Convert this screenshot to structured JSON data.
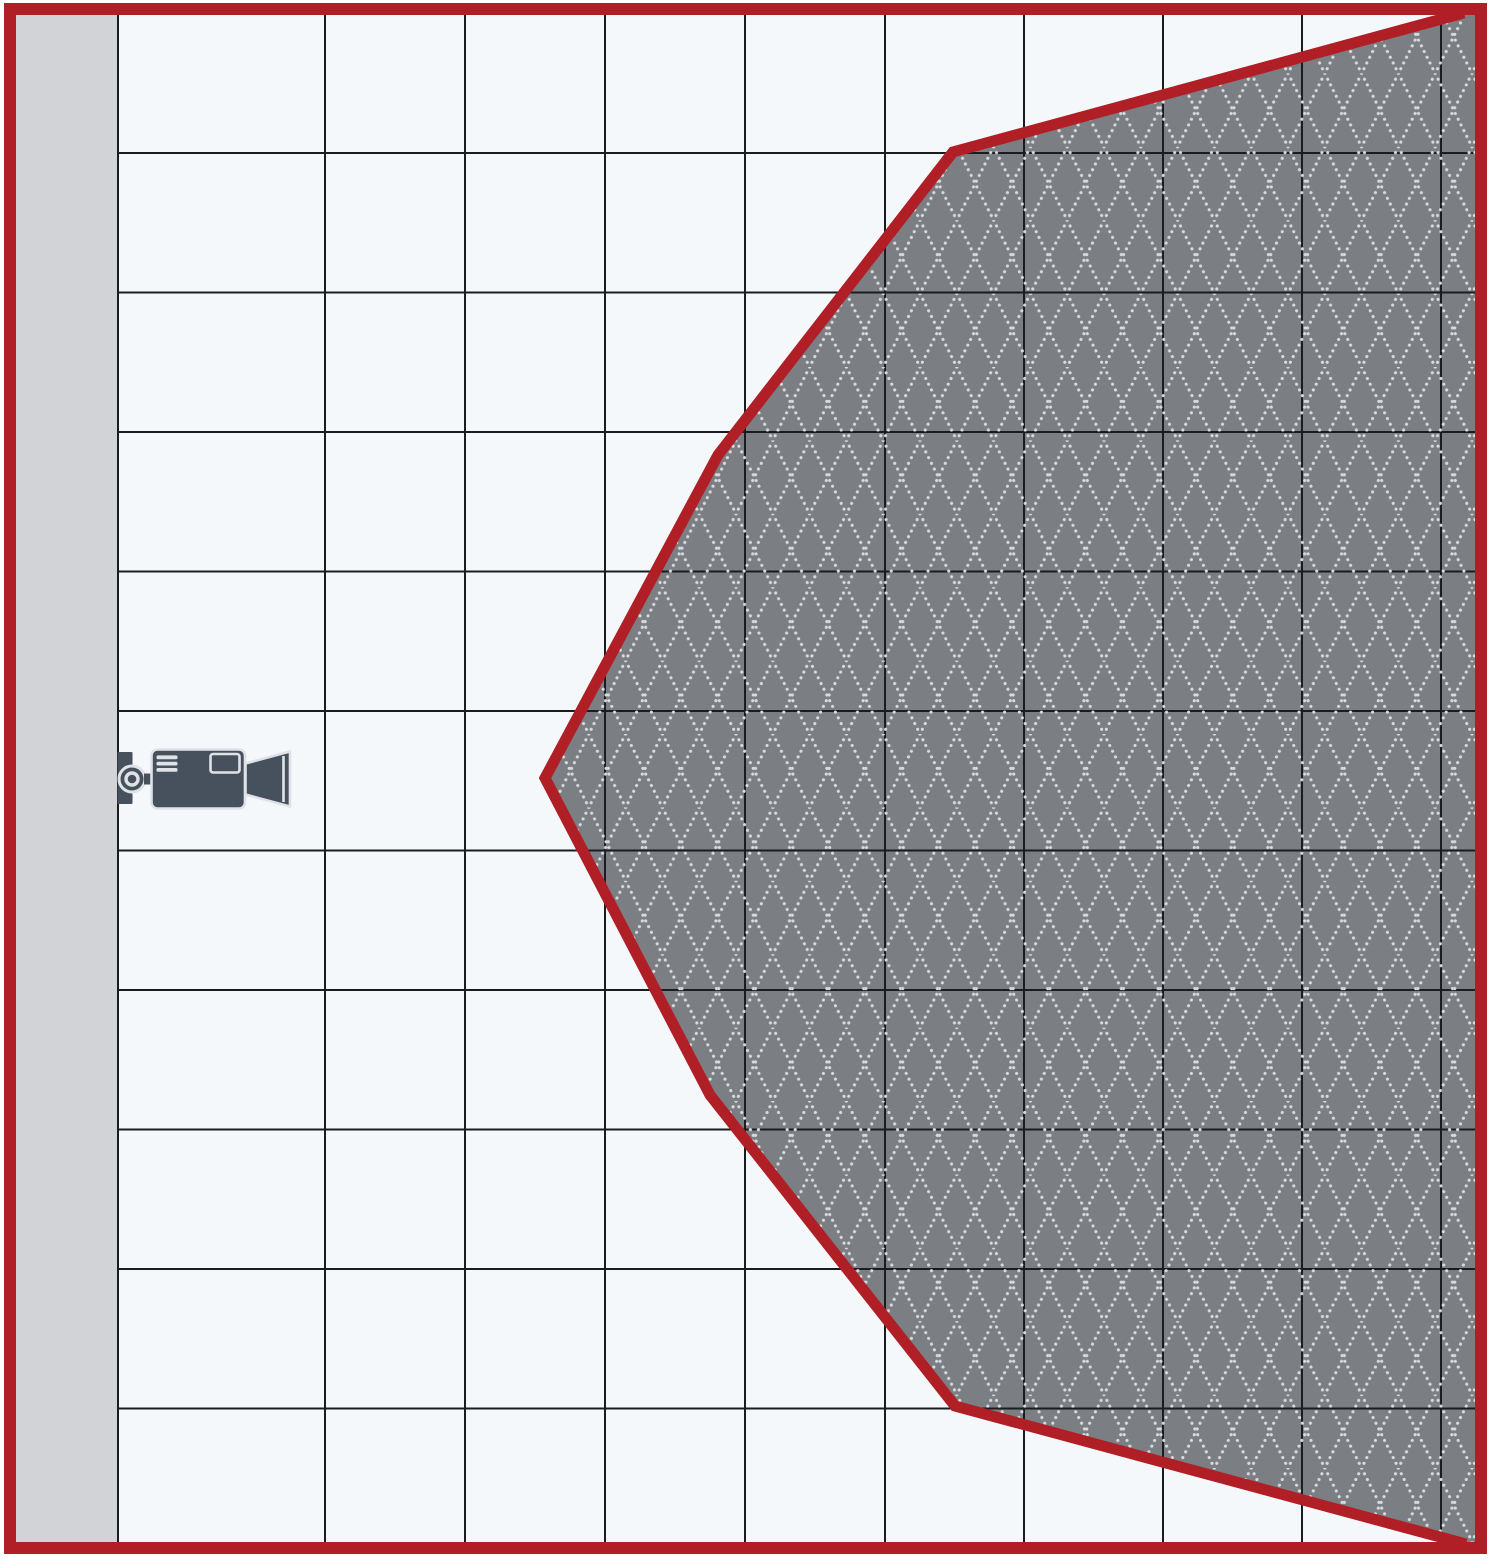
{
  "diagram": {
    "name": "camera-coverage-diagram",
    "description": "Top-view field-of-view coverage diagram of a wall-mounted video camera on a square grid",
    "canvas": {
      "width": 1491,
      "height": 1559
    },
    "colors": {
      "page_bg": "#ffffff",
      "border_red": "#b01f26",
      "cell_bg": "#f5f8fb",
      "wall_gray": "#d1d3d7",
      "grid_line": "#1b1c20",
      "coverage_fill": "#7b7e82",
      "coverage_dot": "#d8dadc",
      "camera_dark": "#47515d",
      "camera_light": "#dfe3e7"
    },
    "border": {
      "x": 10,
      "y": 9,
      "w": 1471,
      "h": 1539,
      "stroke_width": 12
    },
    "grid": {
      "area": {
        "x0": 16,
        "y0": 15,
        "x1": 1475,
        "y1": 1542
      },
      "wall_right_x": 118,
      "column_lines_x": [
        118,
        325,
        465,
        605,
        745,
        885,
        1024,
        1163,
        1302,
        1441
      ],
      "row_lines_y": [
        153,
        292.5,
        432,
        571.5,
        711,
        850.5,
        990,
        1129.5,
        1269,
        1408.5
      ],
      "line_width": 2
    },
    "coverage": {
      "polygon": [
        [
          1475,
          15
        ],
        [
          1459,
          15
        ],
        [
          953,
          152
        ],
        [
          718,
          455
        ],
        [
          545,
          778
        ],
        [
          710,
          1095
        ],
        [
          955,
          1406
        ],
        [
          1461,
          1542
        ],
        [
          1475,
          1542
        ]
      ],
      "outline": [
        [
          1464,
          13
        ],
        [
          953,
          152
        ],
        [
          718,
          455
        ],
        [
          545,
          778
        ],
        [
          710,
          1095
        ],
        [
          955,
          1406
        ],
        [
          1466,
          1544
        ]
      ],
      "outline_width": 11,
      "pattern": {
        "tile_w": 36.8,
        "tile_h": 73.4,
        "dot_size": 3.1,
        "dot_gap": 6.3
      }
    },
    "camera": {
      "icon": "video-camera-icon",
      "cx": 132,
      "cy": 779
    }
  }
}
